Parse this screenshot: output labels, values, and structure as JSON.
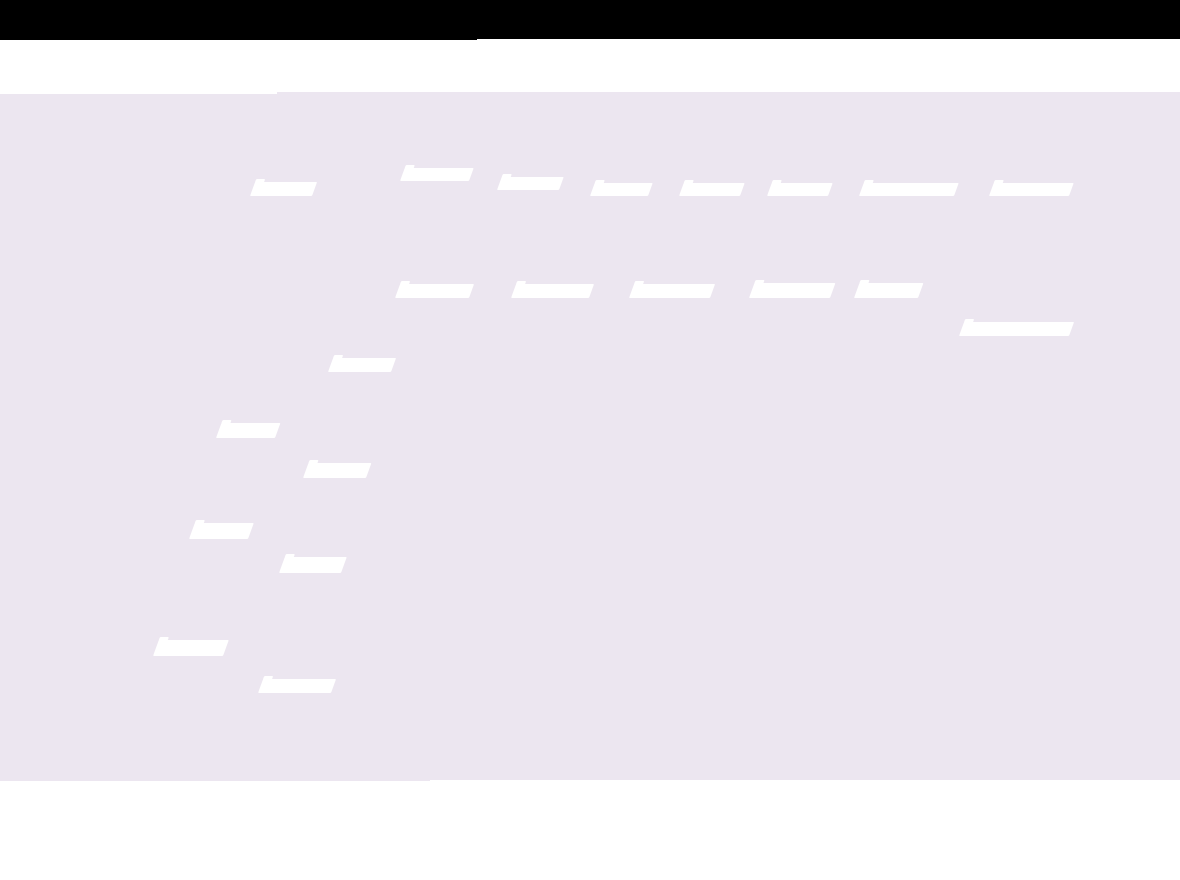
{
  "colors": {
    "header_bg": "#000000",
    "toolbar_bg": "#ffffff",
    "map_bg": "#ece6f0",
    "map_label_color": "#ffffff",
    "footer_bg": "#ffffff"
  },
  "map_labels": [
    {
      "x": 250,
      "y": 182,
      "w": 62,
      "h": 14
    },
    {
      "x": 400,
      "y": 168,
      "w": 69,
      "h": 13
    },
    {
      "x": 497,
      "y": 177,
      "w": 62,
      "h": 13
    },
    {
      "x": 590,
      "y": 183,
      "w": 58,
      "h": 13
    },
    {
      "x": 679,
      "y": 183,
      "w": 61,
      "h": 13
    },
    {
      "x": 767,
      "y": 183,
      "w": 61,
      "h": 13
    },
    {
      "x": 859,
      "y": 183,
      "w": 95,
      "h": 13
    },
    {
      "x": 989,
      "y": 183,
      "w": 80,
      "h": 13
    },
    {
      "x": 395,
      "y": 284,
      "w": 74,
      "h": 14
    },
    {
      "x": 511,
      "y": 284,
      "w": 78,
      "h": 14
    },
    {
      "x": 629,
      "y": 284,
      "w": 81,
      "h": 14
    },
    {
      "x": 749,
      "y": 283,
      "w": 81,
      "h": 15
    },
    {
      "x": 854,
      "y": 283,
      "w": 64,
      "h": 15
    },
    {
      "x": 959,
      "y": 322,
      "w": 110,
      "h": 14
    },
    {
      "x": 328,
      "y": 358,
      "w": 63,
      "h": 14
    },
    {
      "x": 216,
      "y": 423,
      "w": 59,
      "h": 15
    },
    {
      "x": 303,
      "y": 463,
      "w": 63,
      "h": 15
    },
    {
      "x": 189,
      "y": 523,
      "w": 59,
      "h": 16
    },
    {
      "x": 279,
      "y": 557,
      "w": 62,
      "h": 16
    },
    {
      "x": 153,
      "y": 640,
      "w": 70,
      "h": 16
    },
    {
      "x": 258,
      "y": 679,
      "w": 73,
      "h": 14
    }
  ]
}
